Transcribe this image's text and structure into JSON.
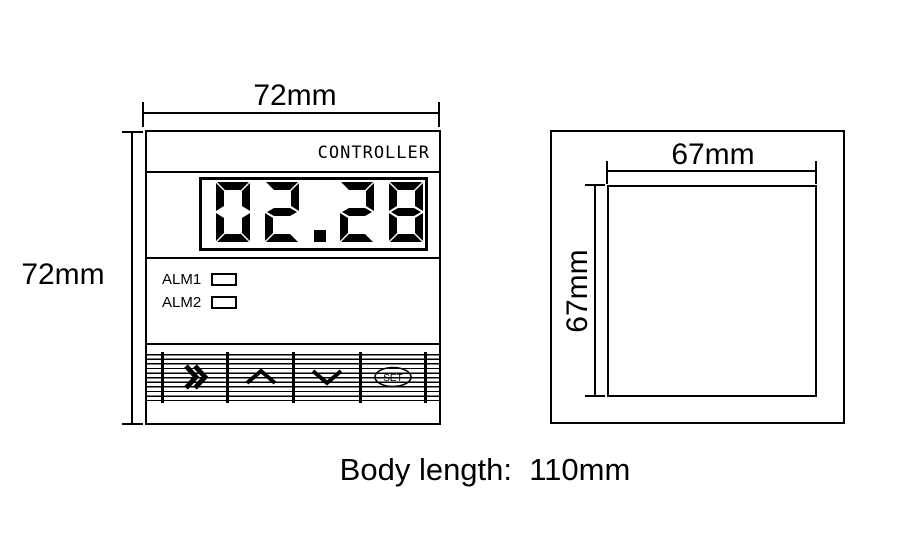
{
  "colors": {
    "ink": "#000000",
    "paper": "#ffffff"
  },
  "front_view": {
    "width_dim": "72mm",
    "height_dim": "72mm",
    "brand": "CONTROLLER",
    "display_value": "02.28",
    "indicators": [
      {
        "label": "ALM1"
      },
      {
        "label": "ALM2"
      }
    ],
    "keypad_buttons": [
      {
        "name": "shift",
        "icon": "double-chevron-right-icon"
      },
      {
        "name": "up",
        "icon": "chevron-up-icon"
      },
      {
        "name": "down",
        "icon": "chevron-down-icon"
      },
      {
        "name": "set",
        "label": "SET"
      }
    ]
  },
  "cutout_view": {
    "width_dim": "67mm",
    "height_dim": "67mm"
  },
  "caption": "Body length:  110mm"
}
